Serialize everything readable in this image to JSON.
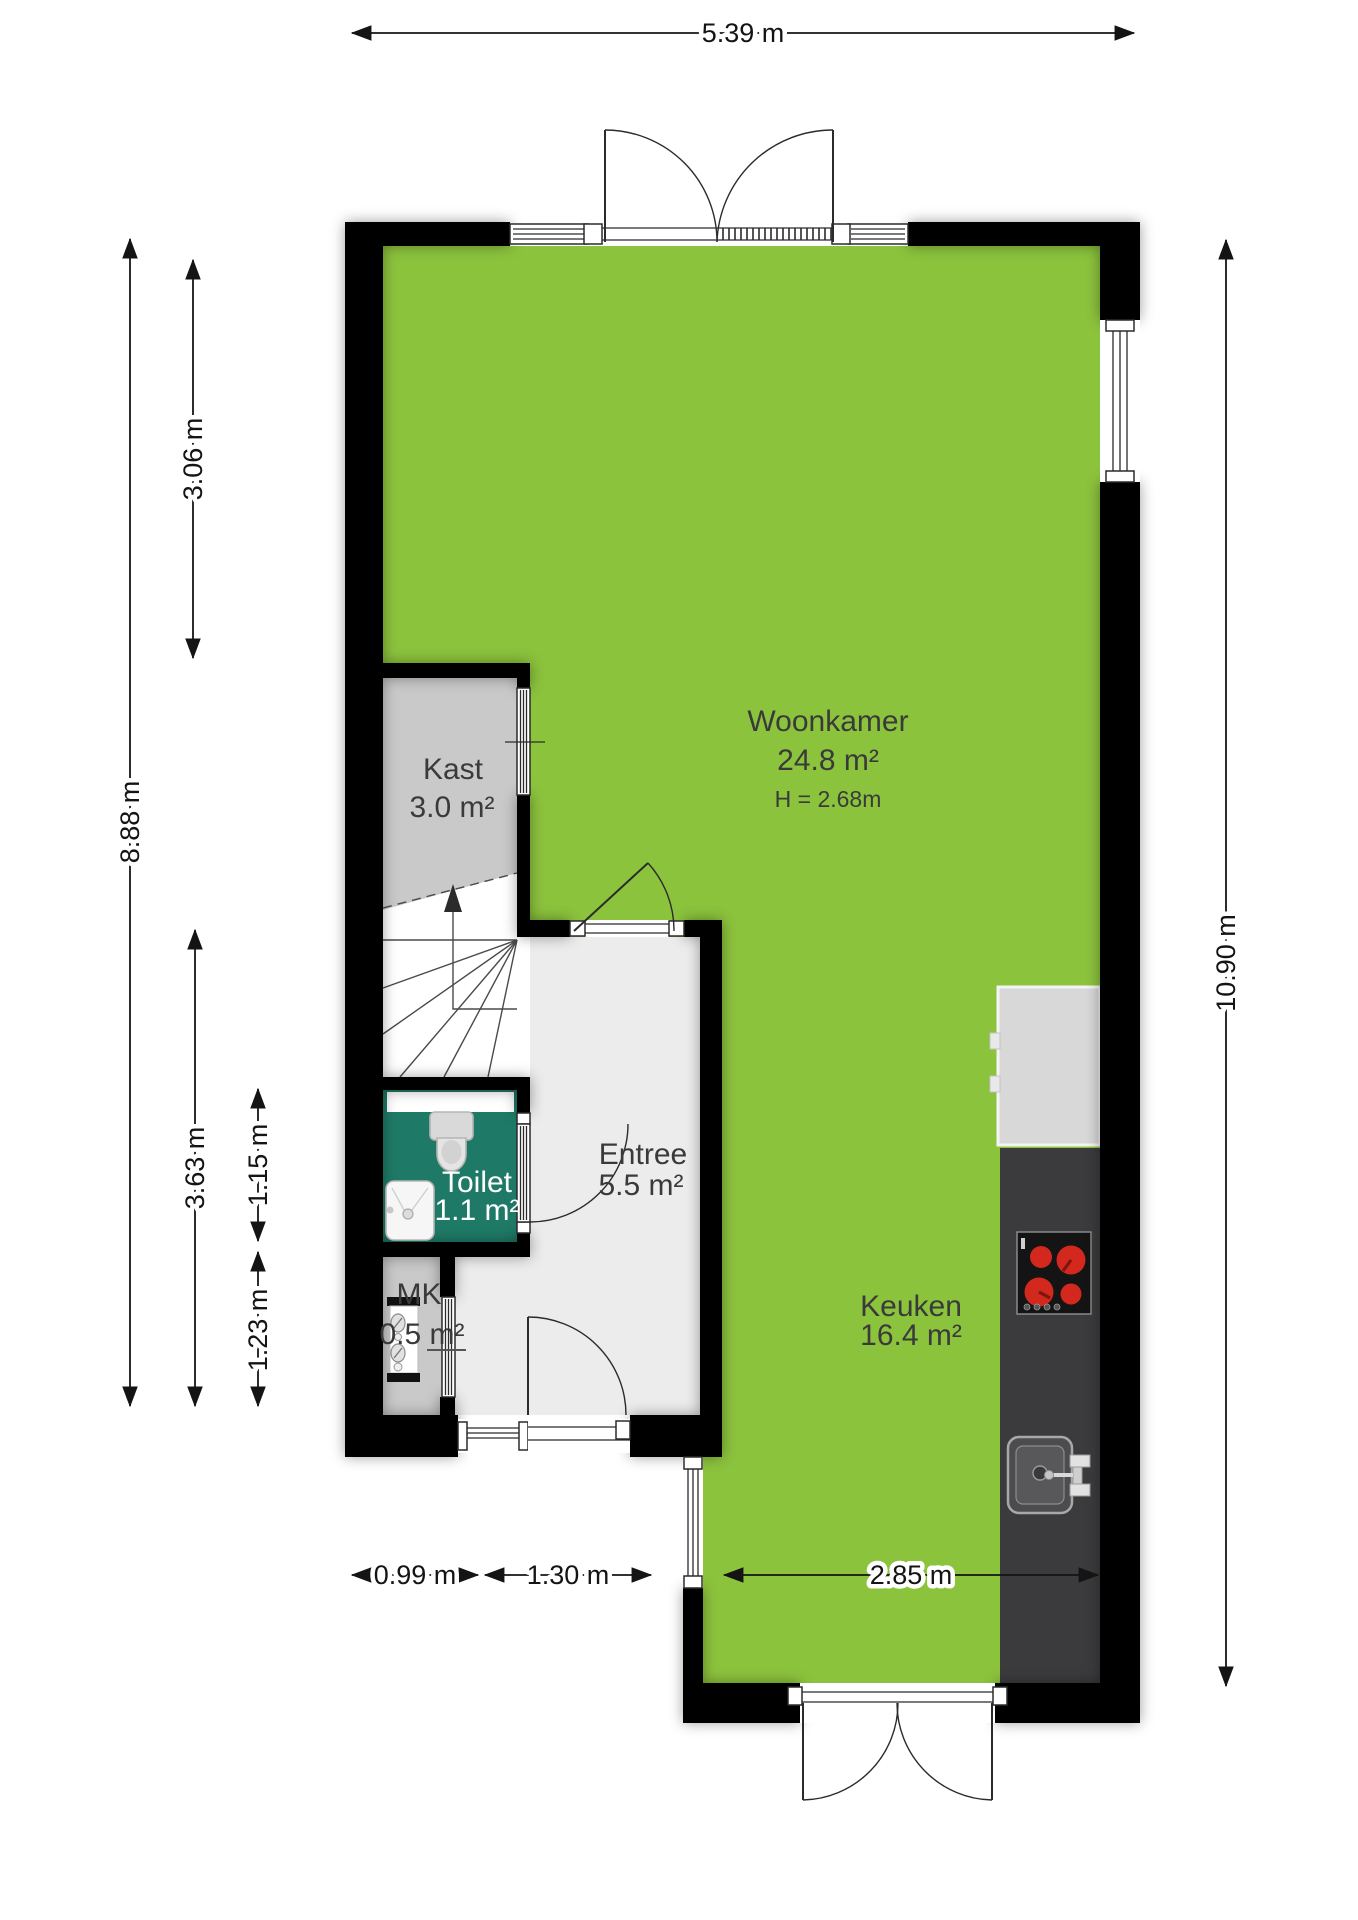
{
  "colors": {
    "floor_green": "#8CC33D",
    "toilet_teal": "#1E7A66",
    "closet_grey": "#C9C9C9",
    "entree_grey": "#ECECEC",
    "counter_dark": "#3B3B3D",
    "appliance_grey": "#D8D8D8",
    "burner_red": "#D3281E",
    "wall_black": "#000000"
  },
  "rooms": {
    "woonkamer": {
      "name": "Woonkamer",
      "area": "24.8 m²",
      "ceiling_height": "H = 2.68m"
    },
    "keuken": {
      "name": "Keuken",
      "area": "16.4 m²"
    },
    "entree": {
      "name": "Entree",
      "area": "5.5 m²"
    },
    "kast": {
      "name": "Kast",
      "area": "3.0 m²"
    },
    "toilet": {
      "name": "Toilet",
      "area": "1.1 m²"
    },
    "mk": {
      "name": "MK",
      "area": "0.5 m²"
    }
  },
  "dimensions": {
    "top_width": "5.39 m",
    "left_total": "8.88 m",
    "left_upper": "3.06 m",
    "left_lower": "3.63 m",
    "toilet_height": "1.15 m",
    "mk_height": "1.23 m",
    "right_total": "10.90 m",
    "bottom_left": "0.99 m",
    "bottom_middle": "1.30 m",
    "bottom_right": "2.85 m"
  }
}
